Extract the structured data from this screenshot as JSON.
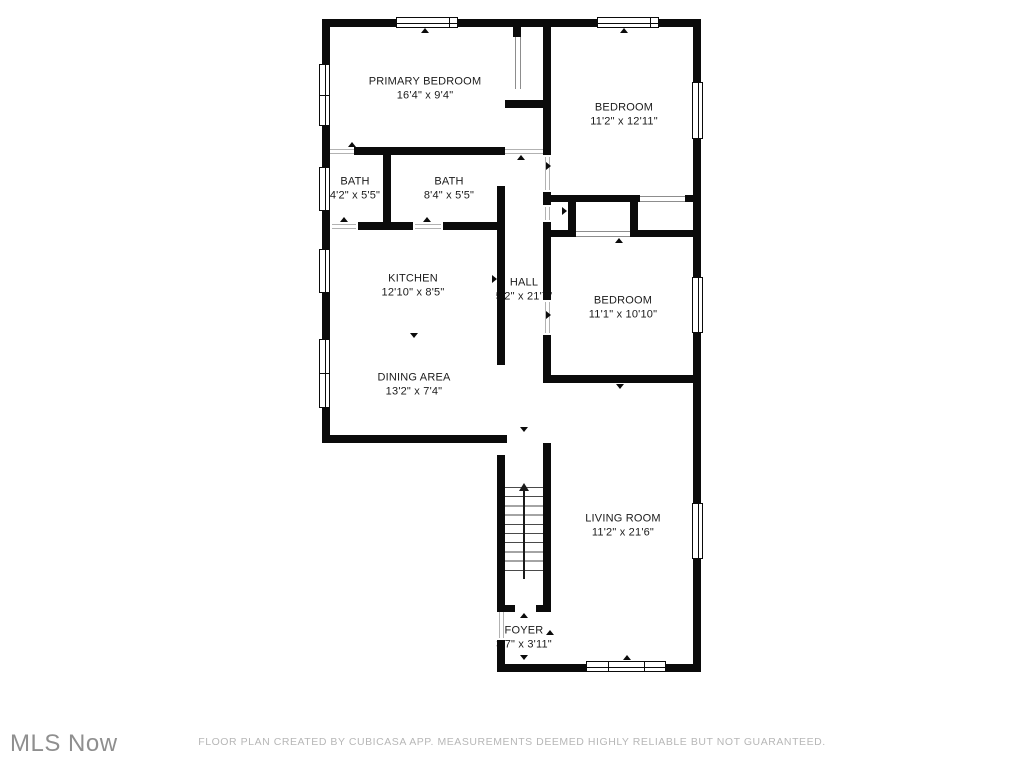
{
  "footer": {
    "watermark": "MLS Now",
    "disclaimer": "FLOOR PLAN CREATED BY CUBICASA APP. MEASUREMENTS DEEMED HIGHLY RELIABLE BUT NOT GUARANTEED."
  },
  "colors": {
    "wall": "#0b0b0b",
    "label_text": "#1b1b1b",
    "watermark_text": "#8f8f8f",
    "disclaimer_text": "#b7b7b7",
    "background": "#ffffff"
  },
  "rooms": [
    {
      "id": "primary-bedroom",
      "name": "PRIMARY BEDROOM",
      "dims": "16'4\" x 9'4\""
    },
    {
      "id": "bedroom-1",
      "name": "BEDROOM",
      "dims": "11'2\" x 12'11\""
    },
    {
      "id": "bath-1",
      "name": "BATH",
      "dims": "4'2\" x 5'5\""
    },
    {
      "id": "bath-2",
      "name": "BATH",
      "dims": "8'4\" x 5'5\""
    },
    {
      "id": "kitchen",
      "name": "KITCHEN",
      "dims": "12'10\" x 8'5\""
    },
    {
      "id": "hall",
      "name": "HALL",
      "dims": "5'2\" x 21'7\""
    },
    {
      "id": "bedroom-2",
      "name": "BEDROOM",
      "dims": "11'1\" x 10'10\""
    },
    {
      "id": "dining-area",
      "name": "DINING AREA",
      "dims": "13'2\" x 7'4\""
    },
    {
      "id": "living-room",
      "name": "LIVING ROOM",
      "dims": "11'2\" x 21'6\""
    },
    {
      "id": "foyer",
      "name": "FOYER",
      "dims": "3'7\" x 3'11\""
    }
  ]
}
